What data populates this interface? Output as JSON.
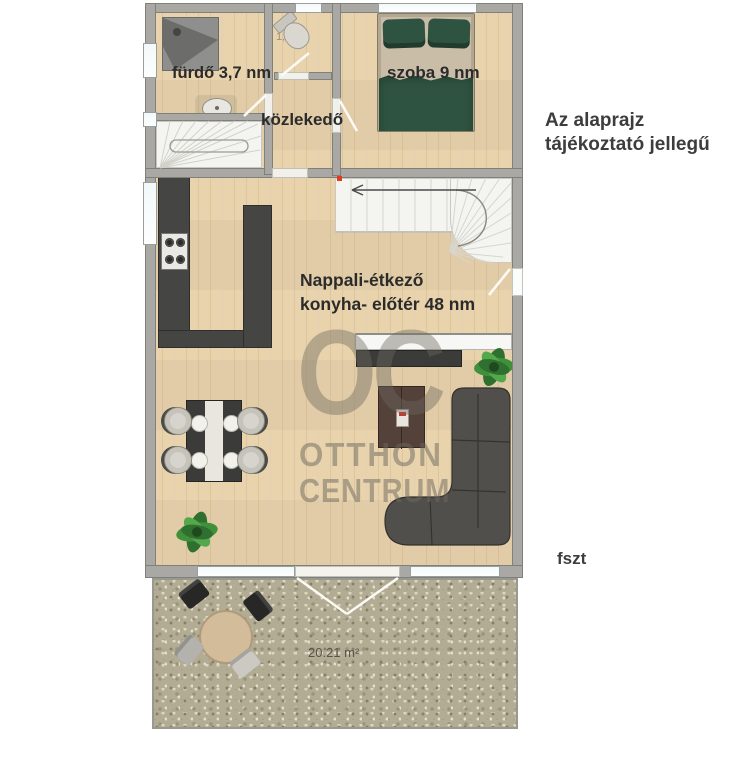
{
  "plan": {
    "rooms": {
      "bathroom_label": "fürdő 3,7 nm",
      "wc_area_label": "1,2 m²",
      "hallway_label": "közlekedő",
      "bedroom_label": "szoba 9 nm",
      "living_label_line1": "Nappali-étkező",
      "living_label_line2": "konyha- előtér 48 nm",
      "terrace_area_label": "20.21 m²"
    },
    "annotations": {
      "disclaimer_line1": "Az alaprajz",
      "disclaimer_line2": "tájékoztató jellegű",
      "floor_label": "fszt"
    },
    "watermark": {
      "monogram": "OC",
      "name_line1": "OTTHON",
      "name_line2": "CENTRUM"
    },
    "colors": {
      "floor_wood": "#e8d3ac",
      "wall": "#a9a8a4",
      "kitchen_counter": "#454543",
      "sofa": "#514f4b",
      "bed_textile": "#2e5340",
      "terrace": "#b3ac94",
      "label_text": "#2b2b2b",
      "watermark": "#6e695f"
    }
  }
}
